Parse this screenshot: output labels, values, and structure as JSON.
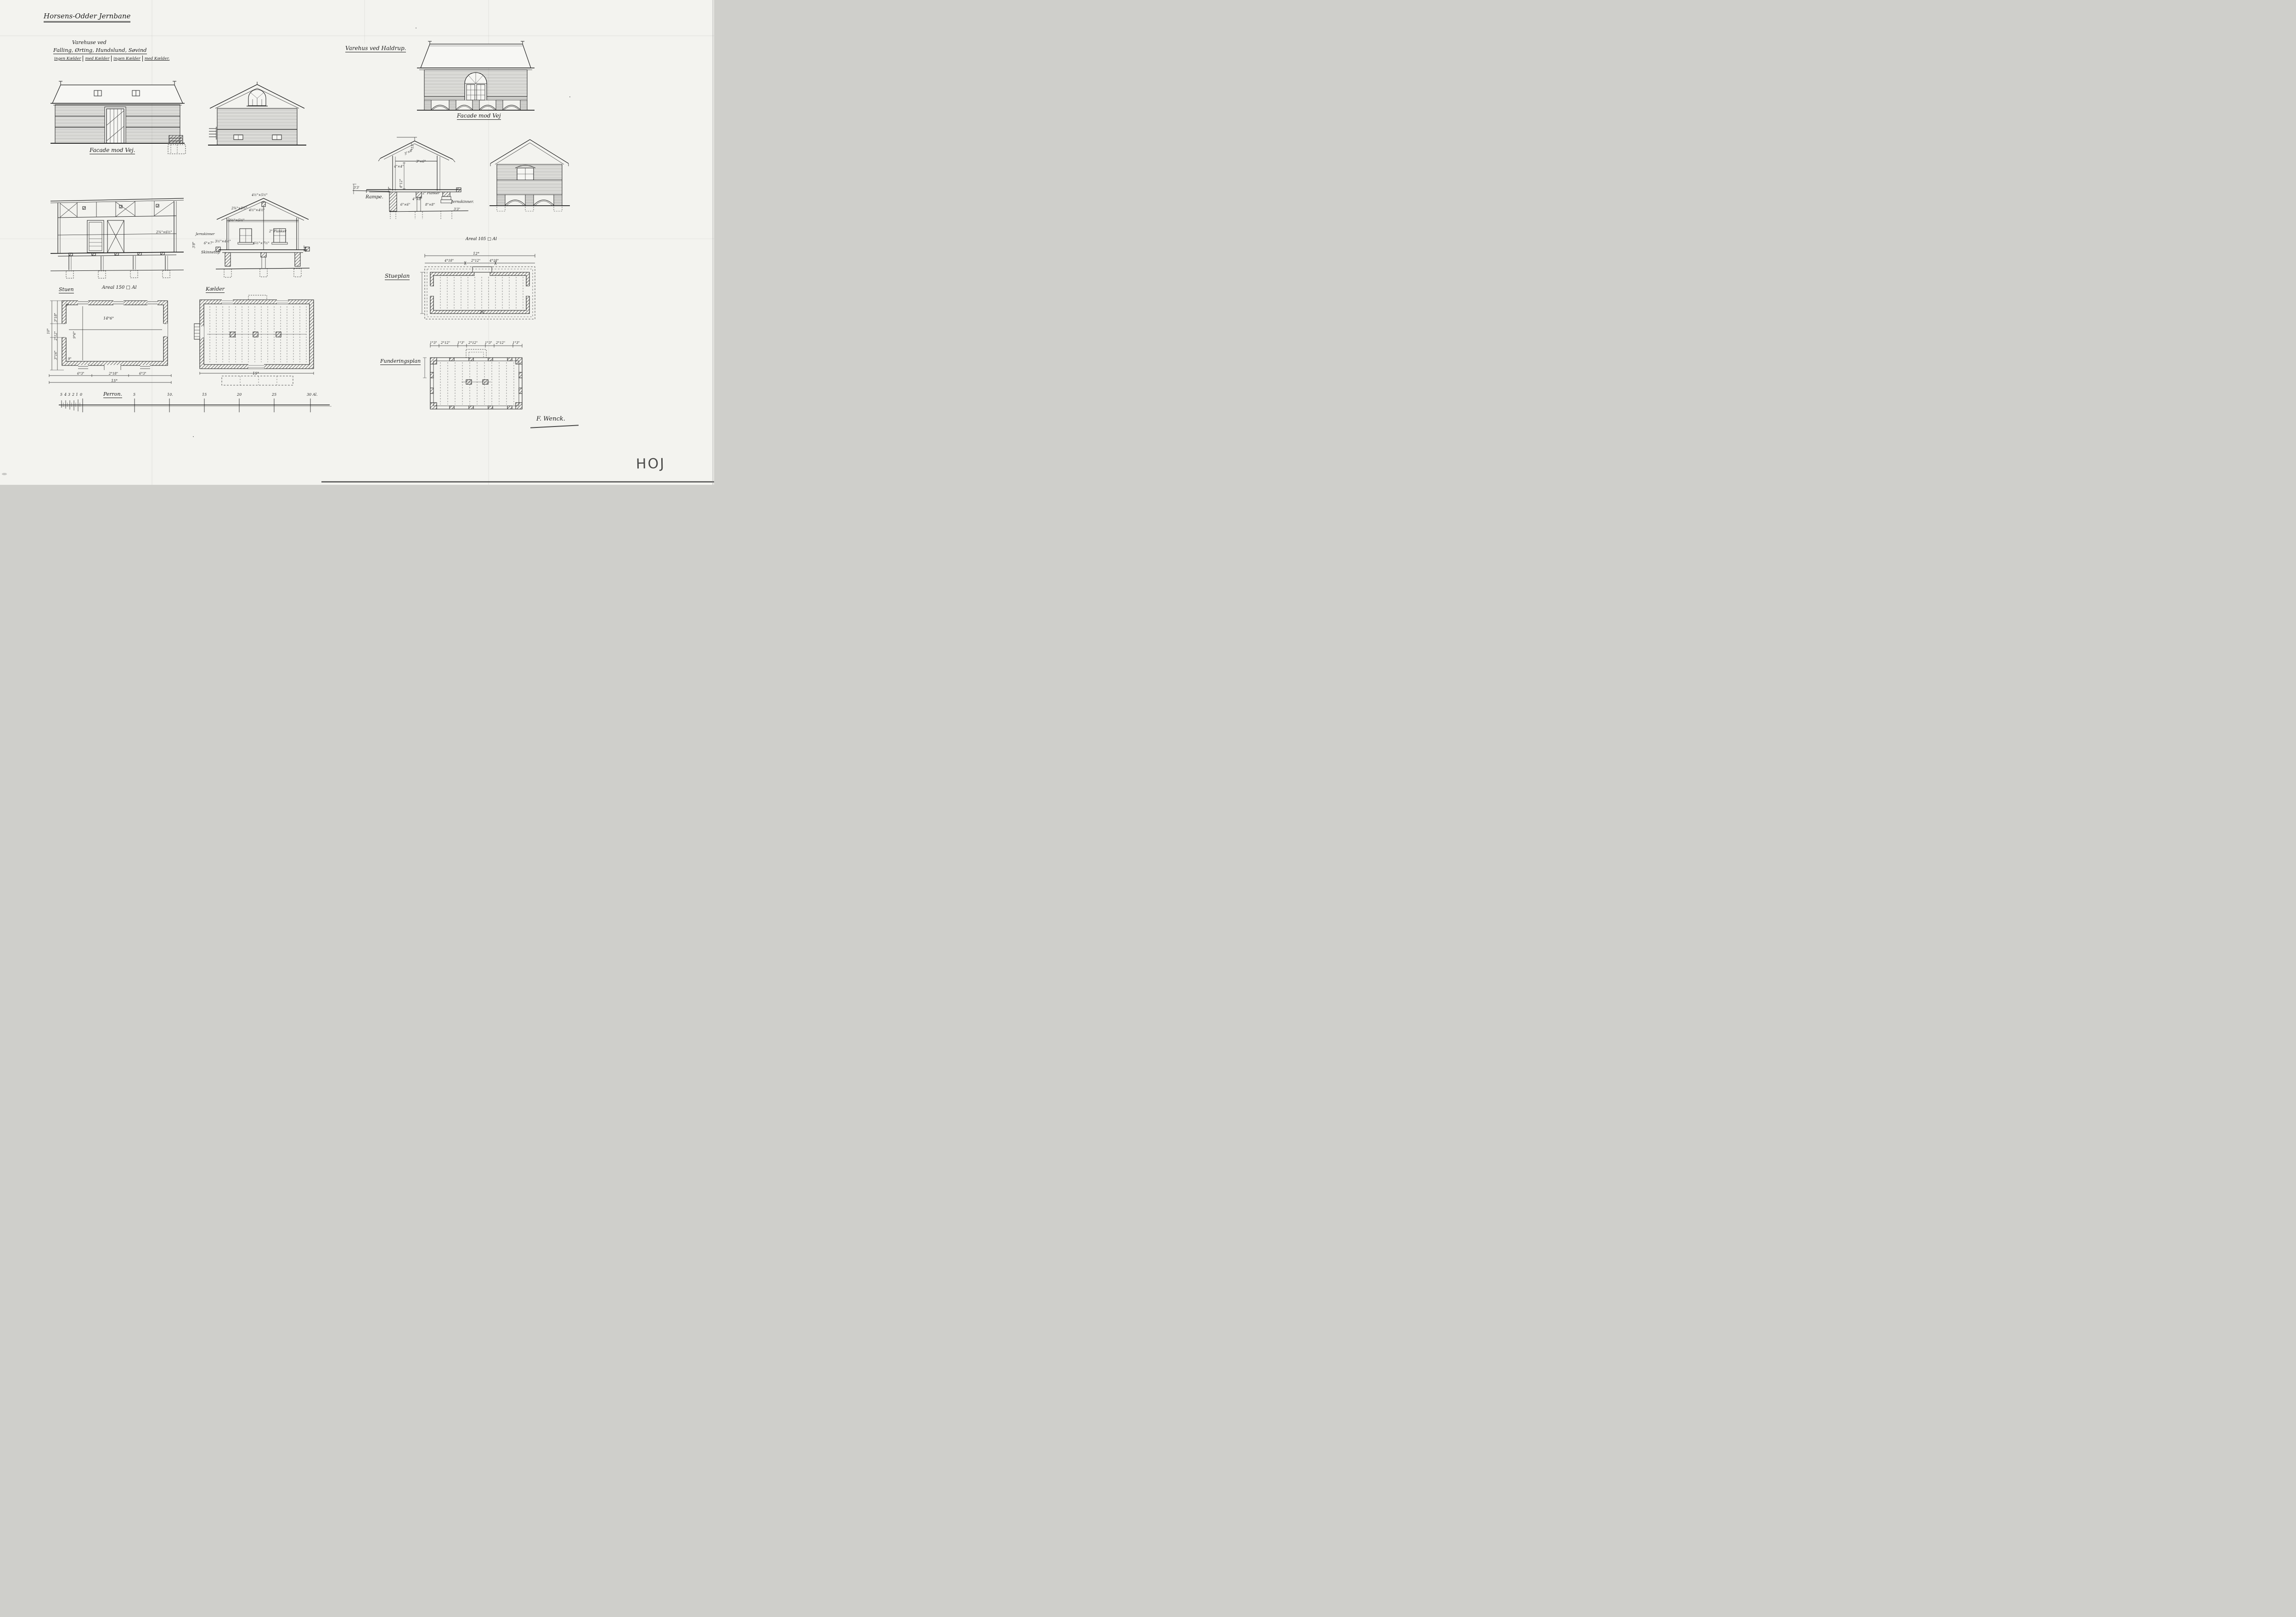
{
  "title": "Horsens-Odder Jernbane",
  "corner_mark": "HOJ",
  "signature": "F. Wenck.",
  "left_sheet": {
    "table": {
      "heading": "Varehuse ved",
      "stations": "Falling, Ørting, Hundslund, Søvind",
      "columns": [
        "ingen Kælder",
        "med Kælder",
        "ingen Kælder",
        "med Kælder."
      ]
    },
    "facade_caption": "Facade mod Vej.",
    "floor_label": "Stuen",
    "area_label": "Areal 150 □ Al",
    "cellar_label": "Kælder",
    "platform_label": "Perron.",
    "plan_dims": {
      "overall_width": "15°",
      "bottom_segments": [
        "6°3\"",
        "2°18\"",
        "6°3\""
      ],
      "left_overall": "10°",
      "left_segments": [
        "3°18\"",
        "2°12\"",
        "3°16\""
      ],
      "inner_width": "14°6\"",
      "inner_depth": "9°6\"",
      "wall_thickness": "9\"",
      "wall_thickness2": "9\""
    },
    "cellar_dims": {
      "overall_width": "15°"
    },
    "section_dims": {
      "floor_joist": "2¾\"×6½\""
    },
    "mid_section_dims": {
      "ridge_beam": "4½\"×5½\"",
      "rafter": "2¾\"×5½\"",
      "king_post": "4½\"×4½\"",
      "collar": "2½\"×5½\"",
      "rail_left": "Jernskinner",
      "planks": "2\" Planker",
      "post": "6\"×7\"",
      "brace": "3½\"×4½\"",
      "beam": "6½\"×7½\"",
      "rail_top": "Skinnetop",
      "height_right": "3'3\"",
      "height_left": "3'8\""
    }
  },
  "right_sheet": {
    "title": "Varehus ved Haldrup.",
    "facade_caption": "Facade mod Vej",
    "ramp_label": "Rampe.",
    "stueplan_label": "Stueplan",
    "stueplan_area": "Areal 105 □ Al",
    "foundation_label": "Funderingsplan",
    "stueplan_dims": {
      "overall_width": "12°",
      "top_segments": [
        "4°18\"",
        "2°12\"",
        "4°18\""
      ]
    },
    "foundation_dims": {
      "top_segments": [
        "1°3\"",
        "2°12\"",
        "1°3\"",
        "2°12\"",
        "1°3\"",
        "2°12\"",
        "1°3\""
      ]
    },
    "section_dims": {
      "ridge_height": "°15\"",
      "rafter": "3\"×6\"",
      "tie_beam": "3\"×6\"",
      "post": "4\"×4\"",
      "room_height": "4°12\"",
      "planks": "2\" Planker",
      "floor_beam": "4\"×8\"",
      "post2": "6\"×6\"",
      "pier": "8\"×8\"",
      "rail": "Jernskinner.",
      "height_right": "3'3\"",
      "height_left": "3'8\"",
      "ramp_height": "3'3'"
    }
  },
  "scale_bar": {
    "minor_labels": [
      "5",
      "4",
      "3",
      "2",
      "1",
      "0"
    ],
    "major_labels": [
      "5",
      "10.",
      "15",
      "20",
      "25",
      "30 Al."
    ]
  }
}
